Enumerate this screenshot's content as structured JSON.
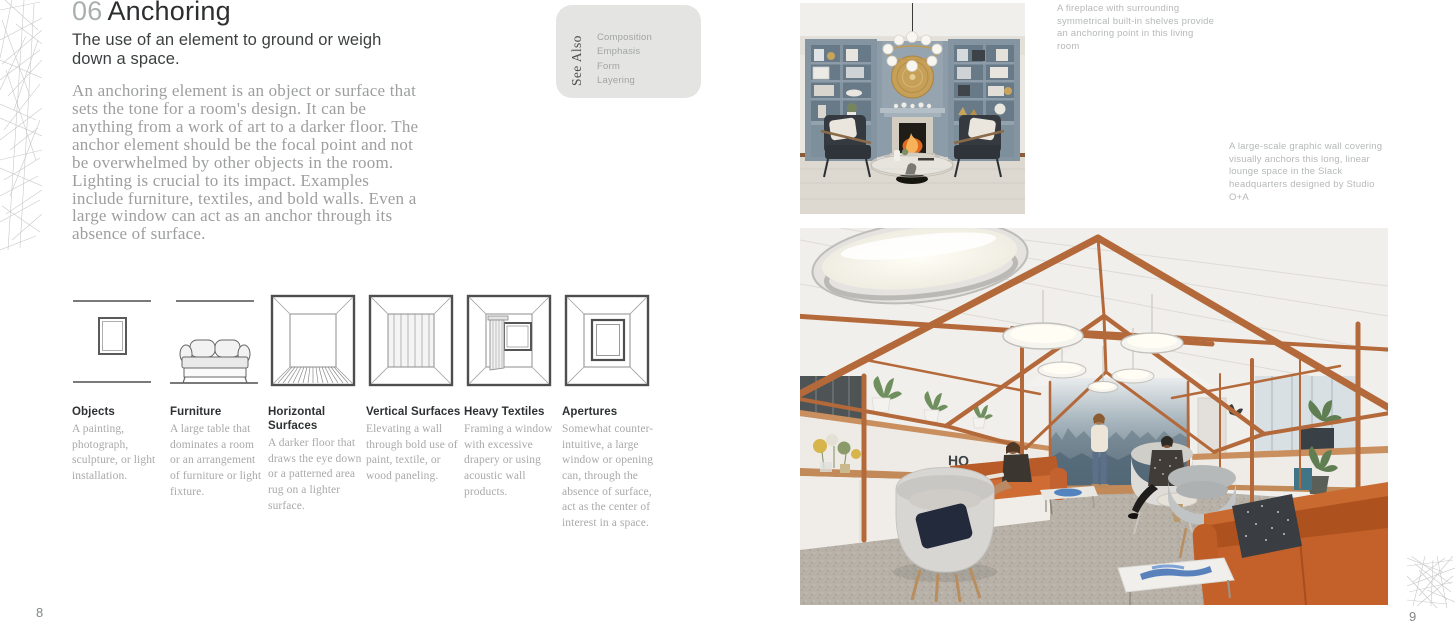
{
  "left_page": {
    "chapter_number": "06",
    "title": "Anchoring",
    "subtitle": "The use of an element to ground or weigh down a space.",
    "body": "An anchoring element is an object or surface that sets the tone for a room's design. It can be anything from a work of art to a darker floor. The anchor element should be the focal point and not be overwhelmed by other objects in the room. Lighting is crucial to its impact. Examples include furniture, textiles, and bold walls. Even a large window can act as an anchor through its absence of surface.",
    "see_also": {
      "label": "See Also",
      "items": [
        "Composition",
        "Emphasis",
        "Form",
        "Layering"
      ]
    },
    "glossary": [
      {
        "label": "Objects",
        "description": "A painting, photograph, sculpture, or light installation.",
        "icon": "framed-art-icon"
      },
      {
        "label": "Furniture",
        "description": "A large table that dominates a room or an arrangement of furniture or light fixture.",
        "icon": "sofa-icon"
      },
      {
        "label": "Horizontal Surfaces",
        "description": "A darker floor that draws the eye down or a patterned area rug on a lighter surface.",
        "icon": "room-floor-icon"
      },
      {
        "label": "Vertical Surfaces",
        "description": "Elevating a wall through bold use of paint, textile, or wood paneling.",
        "icon": "room-paneled-wall-icon"
      },
      {
        "label": "Heavy Textiles",
        "description": "Framing a window with excessive drapery or using acoustic wall products.",
        "icon": "room-curtain-icon"
      },
      {
        "label": "Apertures",
        "description": "Somewhat counter-intuitive, a large window or opening can, through the absence of surface, act as the center of interest in a space.",
        "icon": "room-window-icon"
      }
    ],
    "page_number": "8"
  },
  "right_page": {
    "captions": [
      "A fireplace with surrounding symmetrical built-in shelves provide an anchoring point in this living room",
      "A large-scale graphic wall covering visually anchors this long, linear lounge space in the Slack headquarters designed by Studio O+A"
    ],
    "hq_sign": "HQ",
    "page_number": "9"
  },
  "colors": {
    "frame_orange": "#b4693a",
    "sofa_orange": "#c4612a",
    "builtin_blue": "#8798a4",
    "mural_blue": "#5d7280",
    "see_also_bg": "#e4e4e3",
    "gold_medallion": "#c69f58"
  }
}
